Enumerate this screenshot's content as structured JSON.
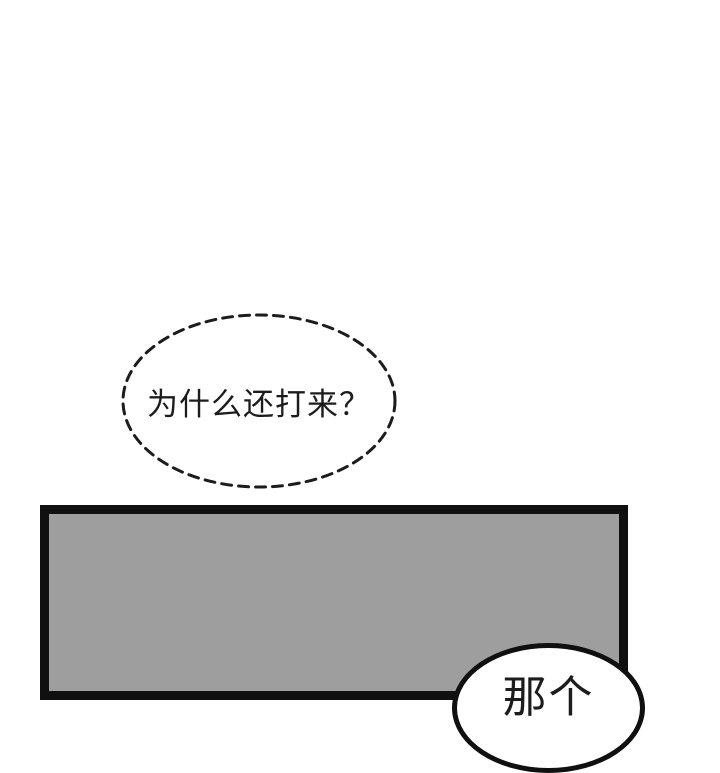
{
  "page": {
    "kind": "comic-page",
    "background_color": "#ffffff"
  },
  "dashed_bubble": {
    "text": "为什么还打来？",
    "shape": "dashed-ellipse",
    "stroke_color": "#1c1c1c",
    "fill_color": "#ffffff"
  },
  "panel": {
    "fill_color": "#9e9e9e",
    "border_color": "#101010"
  },
  "bottom_bubble": {
    "text": "那个",
    "shape": "solid-ellipse",
    "stroke_color": "#101010",
    "fill_color": "#ffffff",
    "note_visible_state": "clipped-at-page-bottom"
  }
}
